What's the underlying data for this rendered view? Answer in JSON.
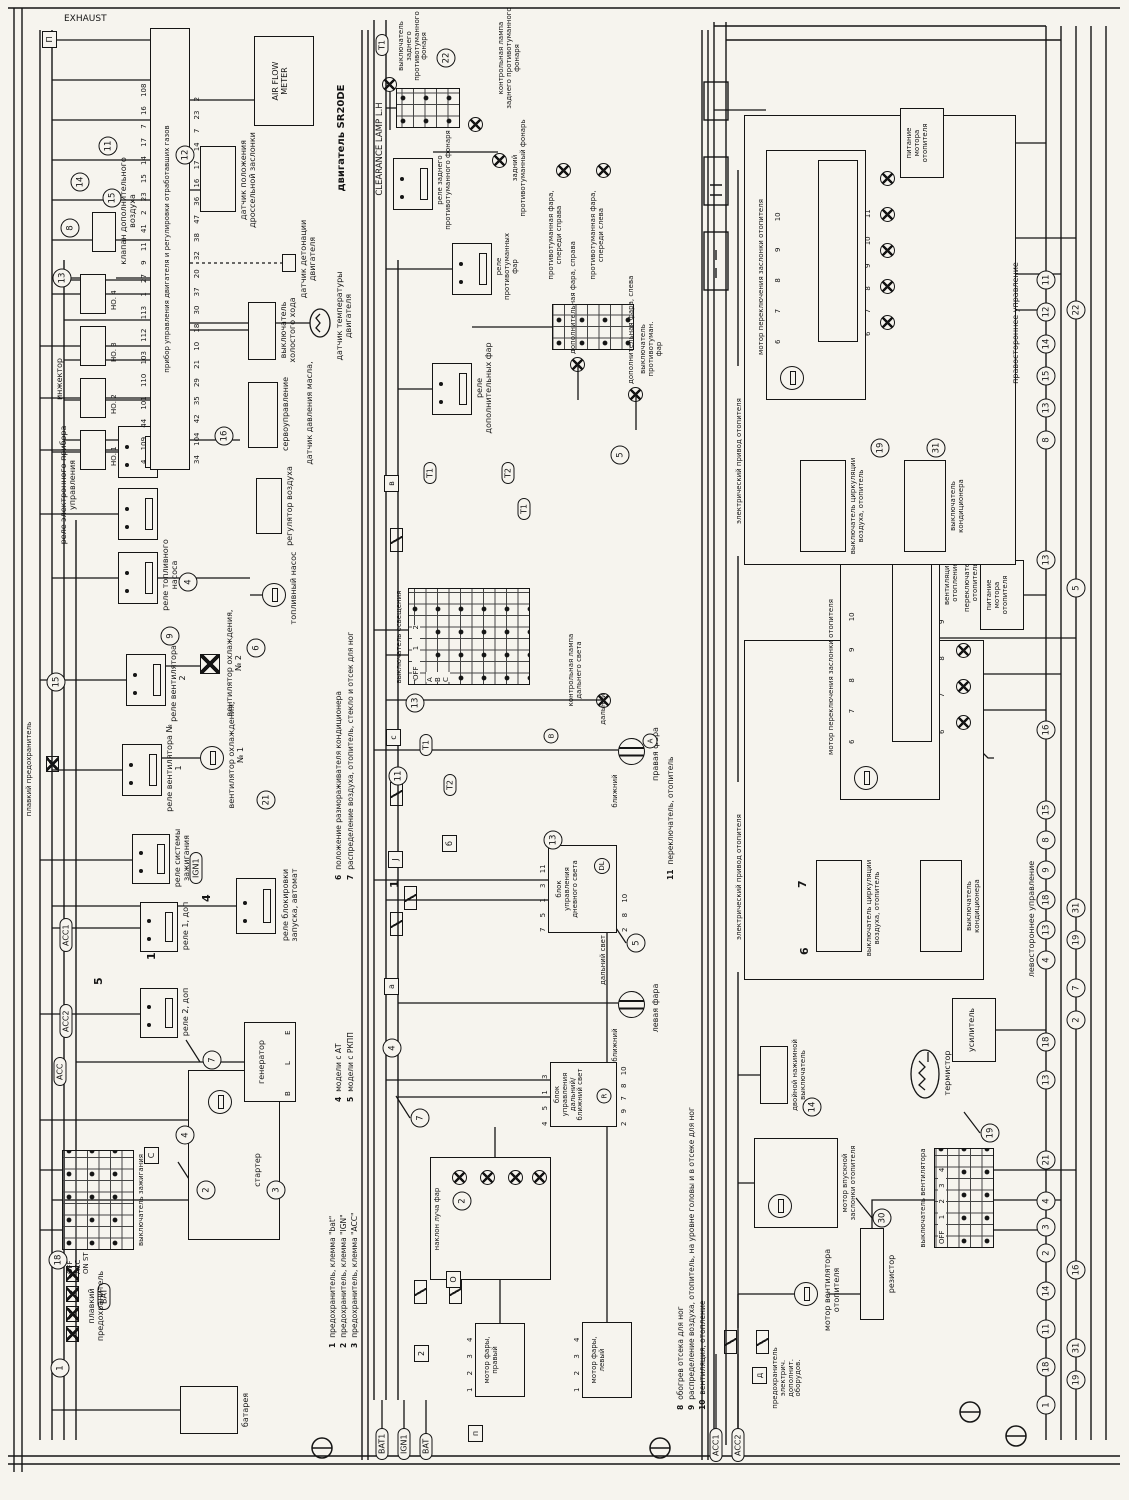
{
  "eng": {
    "exhaust": "EXHAUST",
    "engine": "двигатель SR20DE",
    "ecu": "прибор управления двигателя и регулировки отработавших газов",
    "battery": "батарея",
    "starter": "стартер",
    "fuse_main": "плавкий предохранитель",
    "ign_switch": "выключатель зажигания",
    "start_relay": "реле блокировки запуска, автомат",
    "generator": "генератор",
    "relay2": "реле 2, доп",
    "relay1": "реле 1, доп",
    "ign_relay": "реле системы зажигания",
    "fan_relay1": "реле вентилятора № 1",
    "fan1": "вентилятор охлаждения, № 1",
    "fan_relay2": "реле вентилятора № 2",
    "fan2": "вентилятор охлаждения, № 2",
    "fuel_relay": "реле топливного насоса",
    "fuel_pump": "топливный насос",
    "air_reg": "регулятор воздуха",
    "ecu_relay": "реле электронного прибора управления",
    "servo": "сервоуправление",
    "oil": "датчик давления масла,",
    "idle": "выключатель холостого хода",
    "knock": "датчик детонации двигателя",
    "temp": "датчик температуры двигателя",
    "tps": "датчик положения дроссельной заслонки",
    "afm": "AIR FLOW\nMETER",
    "inj": "инжектор",
    "inj1": "НО. 1",
    "inj2": "НО. 2",
    "inj3": "НО. 3",
    "inj4": "НО. 4",
    "aux_air": "клапан дополнительного воздуха"
  },
  "light": {
    "hl_motor_r": "мотор фары,\nправый",
    "hl_motor_l": "мотор фары,\nлевый",
    "tilt": "наклон луча фар",
    "hilo": "блок\nуправления\nдальний/\nближний свет",
    "drl": "блок\nуправления\nдневного света",
    "r": "R",
    "dl": "DL",
    "a": "A",
    "b": "B",
    "lamp_l": "левая фара",
    "lamp_r": "правая фара",
    "low": "ближний",
    "high": "дальний",
    "high2": "дальний свет",
    "hb_ind": "контрольная лампа\nдальнего света",
    "lsw": "выключатель освещения",
    "aux_relay": "реле дополнительных фар",
    "aux_l": "дополнительная фара, слева",
    "aux_r": "дополнительная фара, справа",
    "fog_sw": "выключатель\nпротивотуман.\nфар",
    "fog_relay": "реле\nпротивотуманных\nфар",
    "fog_l": "противотуманная фара,\nспереди слева",
    "fog_r": "противотуманная фара,\nспереди справа",
    "rfog_relay": "реле заднего\nпротивотуманного фонаря",
    "rfog": "задний\nпротивотуманный фонарь",
    "rfog_ind": "контрольная лампа\nзаднего противотуманного\nфонаря",
    "rfog_sw": "выключатель\nзаднего\nпротивотуманного\nфонаря",
    "clr": "CLEARANCE LAMP L.H"
  },
  "heat": {
    "acc_fuse": "предохранитель\nэлектрич.\nдополнит.\nоборудов.",
    "fan_motor": "мотор вентилятора\nотопителя",
    "res": "резистор",
    "fan_sw": "выключатель вентилятора",
    "therm": "термистор",
    "amp": "усилитель",
    "dbl_sw": "двойной нажимной\nвыключатель",
    "intake": "мотор впускной\nзаслонки отопителя",
    "ac_sw": "выключатель\nкондиционера",
    "circ_sw": "выключатель циркуляции\nвоздуха, отопитель",
    "el_drive": "электрический привод отопителя",
    "flap_motor": "мотор переключения заслонки отопителя",
    "feed": "питание\nмотора\nотопителя",
    "vent": "вентиляция,\nотопление",
    "h_sw": "переключатель,\nотопитель",
    "rhd": "правостороннее управление",
    "lhd": "левостороннее управление"
  },
  "tags": {
    "bat": "BAT",
    "bat1": "BAT1",
    "ign1": "IGN1",
    "acc": "ACC",
    "acc1": "ACC1",
    "acc2": "ACC2",
    "t1": "T1",
    "t2": "T2"
  },
  "pins": {
    "p14": "1 2 3 4",
    "p610": "6 7 8 9 10",
    "p69": "6 7 8 9",
    "p611": "6 7 8 9 10 11",
    "gen": "B L E",
    "hilo_t": "4 5 1 3",
    "hilo_b": "2 9 7 8 10",
    "drl_t": "7 5 1 3 11",
    "drl_b": "2 8 10",
    "ecu_t": "4 109 44 101 110 103 112 113 1 27 9 11 41 2 23 15 14 17 7 16 108",
    "ecu_b": "34 104 42 35 29 21 10 18 30 37 20 32 38 47 36 16 17 14 7 23 2"
  },
  "grids": {
    "ign_rows": "OFF ACC ON ST",
    "lsw_head": "OFF 1 2",
    "lsw_rows": "А В С",
    "fog": "OFF ON",
    "fan": "OFF 1 2 3 4"
  },
  "notes": [
    {
      "n": "1",
      "t": "предохранитель, клемма \"bat\""
    },
    {
      "n": "2",
      "t": "предохранитель, клемма \"IGN\""
    },
    {
      "n": "3",
      "t": "предохранитель, клемма \"ACC\""
    },
    {
      "n": "4",
      "t": "модели с АТ"
    },
    {
      "n": "5",
      "t": "модели с РКПП"
    },
    {
      "n": "6",
      "t": "положение размораживателя кондиционера"
    },
    {
      "n": "7",
      "t": "распределение воздуха, отопитель, стекло и отсек для ног"
    },
    {
      "n": "8",
      "t": "обогрев отсека для ног"
    },
    {
      "n": "9",
      "t": "распределение воздуха, отопитель, на уровне головы и в отсеке для ног"
    },
    {
      "n": "10",
      "t": "вентиляция, отопление"
    },
    {
      "n": "11",
      "t": "переключатель, отопитель"
    }
  ],
  "coE": [
    "1",
    "18",
    "2",
    "3",
    "4",
    "7",
    "21",
    "15",
    "9",
    "6",
    "4",
    "16",
    "13",
    "8",
    "15",
    "14",
    "11",
    "12"
  ],
  "coL": [
    "2",
    "7",
    "4",
    "5",
    "13",
    "11",
    "13",
    "5",
    "22"
  ],
  "coH": [
    "30",
    "19",
    "14",
    "19",
    "31"
  ],
  "busA": [
    "1",
    "18",
    "11",
    "14",
    "2",
    "3",
    "4",
    "21",
    "13",
    "18",
    "4",
    "13",
    "18",
    "9",
    "8",
    "15",
    "16",
    "13",
    "8",
    "13",
    "15",
    "14",
    "12",
    "11"
  ],
  "busB": [
    "19",
    "31",
    "16",
    "2",
    "7",
    "19",
    "31",
    "5",
    "22"
  ],
  "nums": {
    "a": "5",
    "b": "4",
    "c": "1",
    "d": "1",
    "e": "6",
    "f": "7"
  }
}
